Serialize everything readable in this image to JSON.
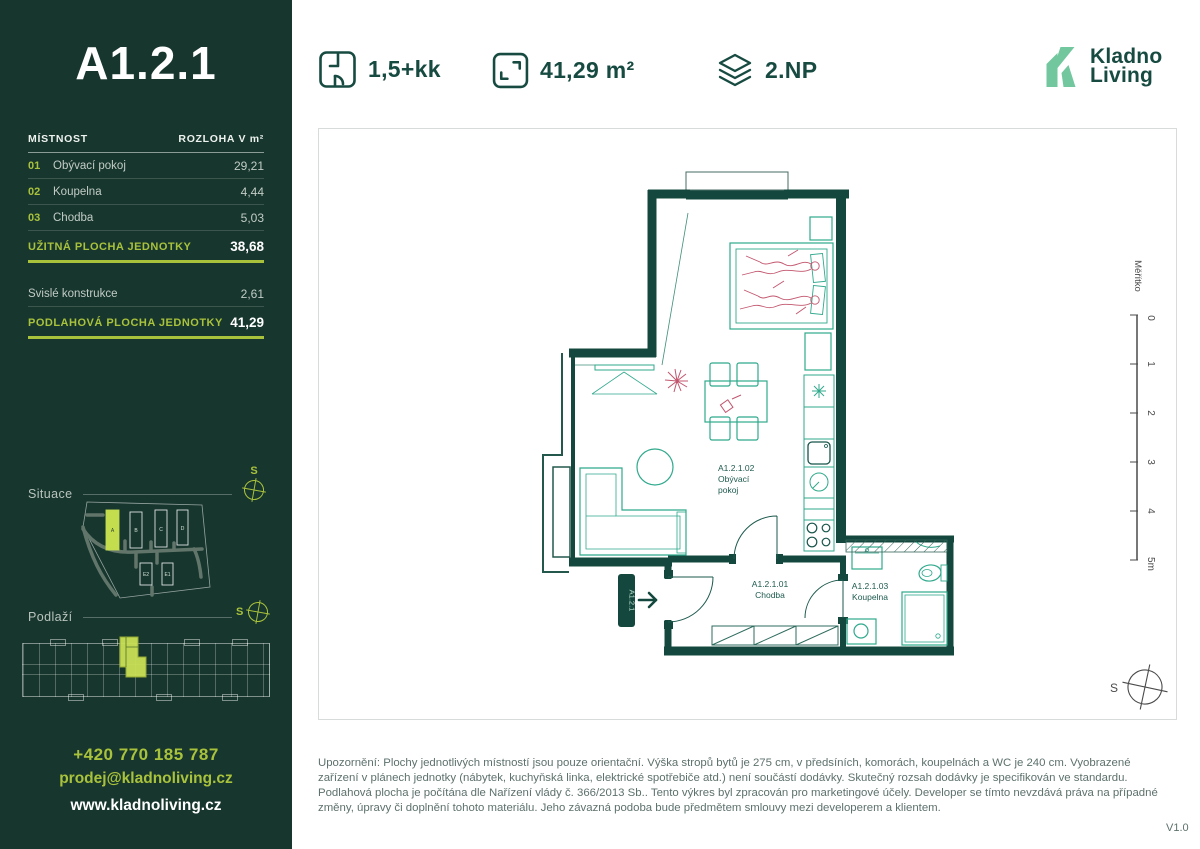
{
  "sidebar": {
    "unit_title": "A1.2.1",
    "table": {
      "col_room": "MÍSTNOST",
      "col_area": "ROZLOHA V m²",
      "rows": [
        {
          "num": "01",
          "name": "Obývací pokoj",
          "area": "29,21"
        },
        {
          "num": "02",
          "name": "Koupelna",
          "area": "4,44"
        },
        {
          "num": "03",
          "name": "Chodba",
          "area": "5,03"
        }
      ],
      "usable_label": "UŽITNÁ PLOCHA JEDNOTKY",
      "usable_value": "38,68",
      "vertical_label": "Svislé konstrukce",
      "vertical_value": "2,61",
      "floor_label": "PODLAHOVÁ PLOCHA JEDNOTKY",
      "floor_value": "41,29"
    },
    "situace_label": "Situace",
    "podlazi_label": "Podlaží",
    "compass_letter": "S",
    "site_buildings": {
      "a": "A",
      "b": "B",
      "c": "C",
      "d": "D",
      "e2": "E2",
      "e1": "E1"
    },
    "phone": "+420 770 185 787",
    "email": "prodej@kladnoliving.cz",
    "website": "www.kladnoliving.cz"
  },
  "header": {
    "disposition": "1,5+kk",
    "area": "41,29 m²",
    "floor": "2.NP",
    "brand_line1": "Kladno",
    "brand_line2": "Living"
  },
  "plan": {
    "entry_badge": "A1.2.1",
    "rooms": {
      "living": {
        "code": "A1.2.1.02",
        "line1": "Obývací",
        "line2": "pokoj"
      },
      "hall": {
        "code": "A1.2.1.01",
        "name": "Chodba"
      },
      "bath": {
        "code": "A1.2.1.03",
        "name": "Koupelna"
      }
    },
    "scale": {
      "label": "Měřítko",
      "ticks": [
        "0",
        "1",
        "2",
        "3",
        "4",
        "5m"
      ]
    },
    "compass_letter": "S"
  },
  "footer": {
    "disclaimer": "Upozornění: Plochy jednotlivých místností jsou pouze orientační. Výška stropů bytů je 275 cm, v předsíních, komorách, koupelnách a WC je 240 cm. Vyobrazené zařízení v plánech jednotky (nábytek, kuchyňská linka, elektrické spotřebiče atd.) není součástí dodávky. Skutečný rozsah dodávky je specifikován ve standardu. Podlahová plocha je počítána dle Nařízení vlády č. 366/2013 Sb.. Tento výkres byl zpracován pro marketingové účely. Developer se tímto nevzdává práva na případné změny, úpravy či doplnění tohoto materiálu. Jeho závazná podoba bude předmětem smlouvy mezi developerem a klientem.",
    "version": "V1.0"
  },
  "colors": {
    "sidebar_bg": "#17362d",
    "accent": "#a9c23c",
    "accent_bright": "#c8e055",
    "wall": "#14483e",
    "furniture": "#2fa98c",
    "figure_red": "#c2556d",
    "brand_mint": "#72c79f",
    "text_gray": "#5d716d"
  }
}
